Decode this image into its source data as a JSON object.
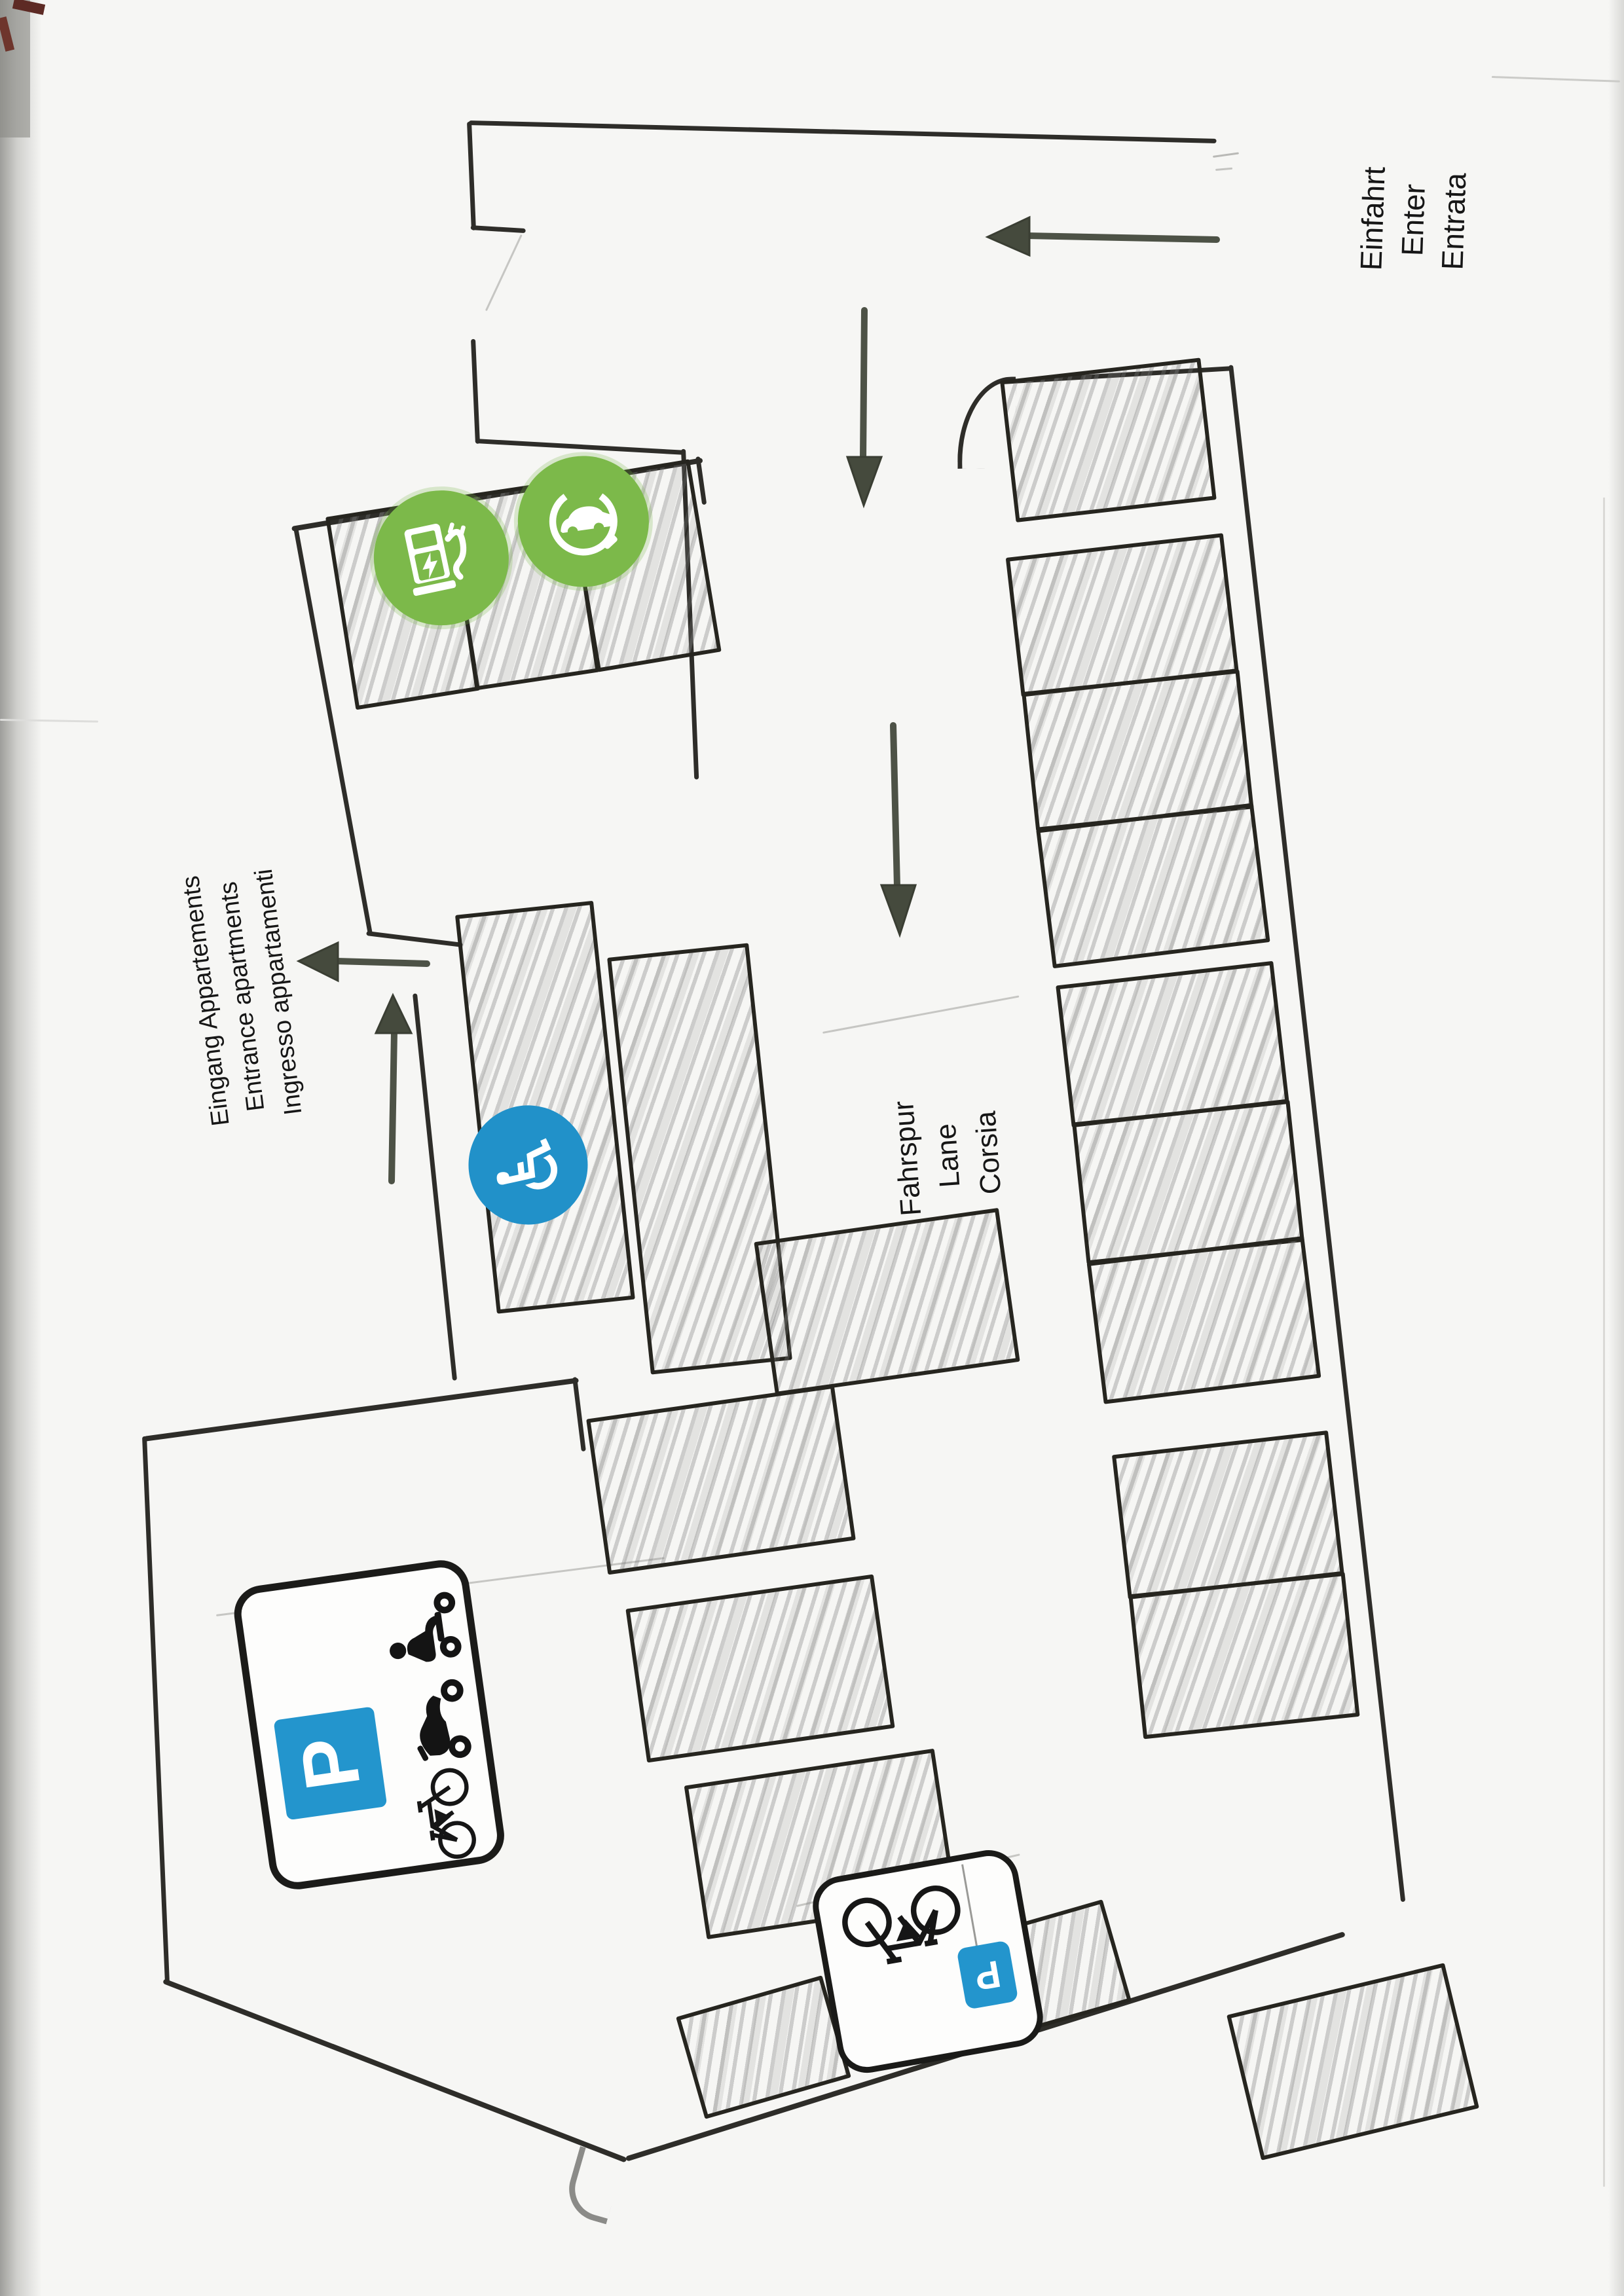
{
  "document": {
    "kind": "scanned hand-drawn parking garage plan",
    "orientation_note": "landscape drawing scanned in portrait; labels read bottom-to-top"
  },
  "labels": {
    "entrance": {
      "lines": [
        "Einfahrt",
        "Enter",
        "Entrata"
      ]
    },
    "apartments_entrance": {
      "lines": [
        "Eingang Appartements",
        "Entrance apartments",
        "Ingresso appartamenti"
      ]
    },
    "lane": {
      "lines": [
        "Fahrspur",
        "Lane",
        "Corsia"
      ]
    }
  },
  "signs": {
    "vehicle_parking": {
      "p_letter": "P",
      "icons": [
        "scooter-icon",
        "motorcycle-icon",
        "bicycle-icon"
      ]
    },
    "bike_parking": {
      "p_letter": "P",
      "icons": [
        "bicycle-icon"
      ]
    },
    "disabled_parking": {
      "wheelchair_glyph": "♿"
    },
    "ev_parking": {
      "icons": [
        "charging-station-icon",
        "electric-car-icon"
      ]
    }
  },
  "arrows": [
    "entry-left-arrow",
    "flow-down-arrow-upper",
    "flow-down-arrow-lower",
    "apartment-left-arrow",
    "apartment-up-arrow"
  ],
  "colors": {
    "parking_blue": "#2395cd",
    "ev_green": "#7cb94a",
    "wall_ink": "#2e2d29",
    "arrow_gray": "#4d5246",
    "hatch_gray": "#9a9a9a",
    "paper": "#f6f6f4"
  },
  "stalls": {
    "ev_block": 3,
    "right_top": 1,
    "right_a": 3,
    "right_b": 3,
    "right_c": 2,
    "right_bottom_single": 1,
    "middle_vertical": 2,
    "middle_horizontal": 4,
    "bottom_pair": 2,
    "total_hatched": 21
  }
}
